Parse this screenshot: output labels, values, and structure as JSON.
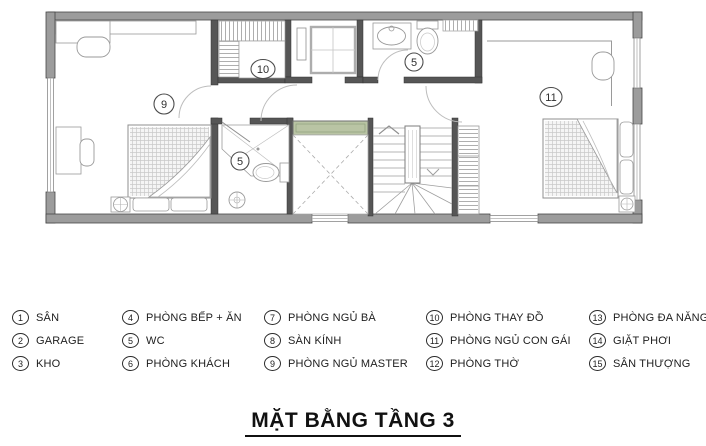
{
  "title": "MẶT BẰNG TẦNG 3",
  "plan": {
    "room_labels": {
      "master_bedroom": "9",
      "dressing_room": "10",
      "wc_upper": "5",
      "wc_lower": "5",
      "daughter_bedroom": "11"
    }
  },
  "legend": {
    "items": [
      {
        "num": "1",
        "label": "SÂN"
      },
      {
        "num": "2",
        "label": "GARAGE"
      },
      {
        "num": "3",
        "label": "KHO"
      },
      {
        "num": "4",
        "label": "PHÒNG BẾP + ĂN"
      },
      {
        "num": "5",
        "label": "WC"
      },
      {
        "num": "6",
        "label": "PHÒNG KHÁCH"
      },
      {
        "num": "7",
        "label": "PHÒNG NGỦ BÀ"
      },
      {
        "num": "8",
        "label": "SÀN KÍNH"
      },
      {
        "num": "9",
        "label": "PHÒNG NGỦ MASTER"
      },
      {
        "num": "10",
        "label": "PHÒNG THAY ĐỒ"
      },
      {
        "num": "11",
        "label": "PHÒNG NGỦ CON GÁI"
      },
      {
        "num": "12",
        "label": "PHÒNG THỜ"
      },
      {
        "num": "13",
        "label": "PHÒNG ĐA NĂNG"
      },
      {
        "num": "14",
        "label": "GIẶT PHƠI"
      },
      {
        "num": "15",
        "label": "SÂN THƯỢNG"
      }
    ]
  },
  "colors": {
    "wall": "#9c9c9c",
    "wall_edge": "#474747",
    "inner_wall": "#565656",
    "planter": "#b9c4a4"
  }
}
